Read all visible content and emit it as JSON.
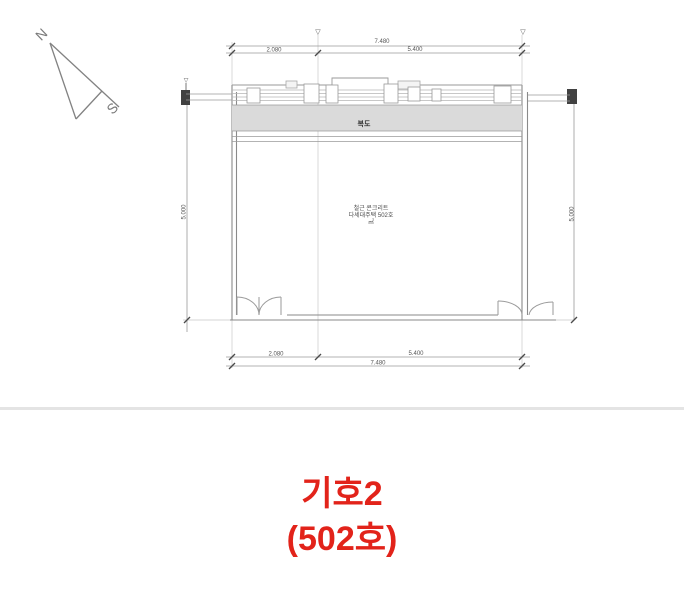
{
  "compass": {
    "north": "N",
    "south": "S"
  },
  "floor_plan": {
    "dim_top_total": "7.480",
    "dim_top_seg1": "2.080",
    "dim_top_seg2": "5.400",
    "dim_bottom_total": "7.480",
    "dim_bottom_seg1": "2.080",
    "dim_bottom_seg2": "5.400",
    "dim_left": "5.000",
    "dim_right": "5.000",
    "level_mark": "▽",
    "corridor_label": "복도",
    "room_label_line1": "철근 콘크리트",
    "room_label_line2": "다세대주택 502호",
    "room_label_line3": "㎡"
  },
  "caption": {
    "line1": "기호2",
    "line2": "(502호)"
  },
  "colors": {
    "caption_red": "#e2231a",
    "wall_gray": "#8a8a8a",
    "dim_gray": "#9a9a9a",
    "band_fill": "#dadada",
    "divider_gray": "#e4e4e4"
  }
}
